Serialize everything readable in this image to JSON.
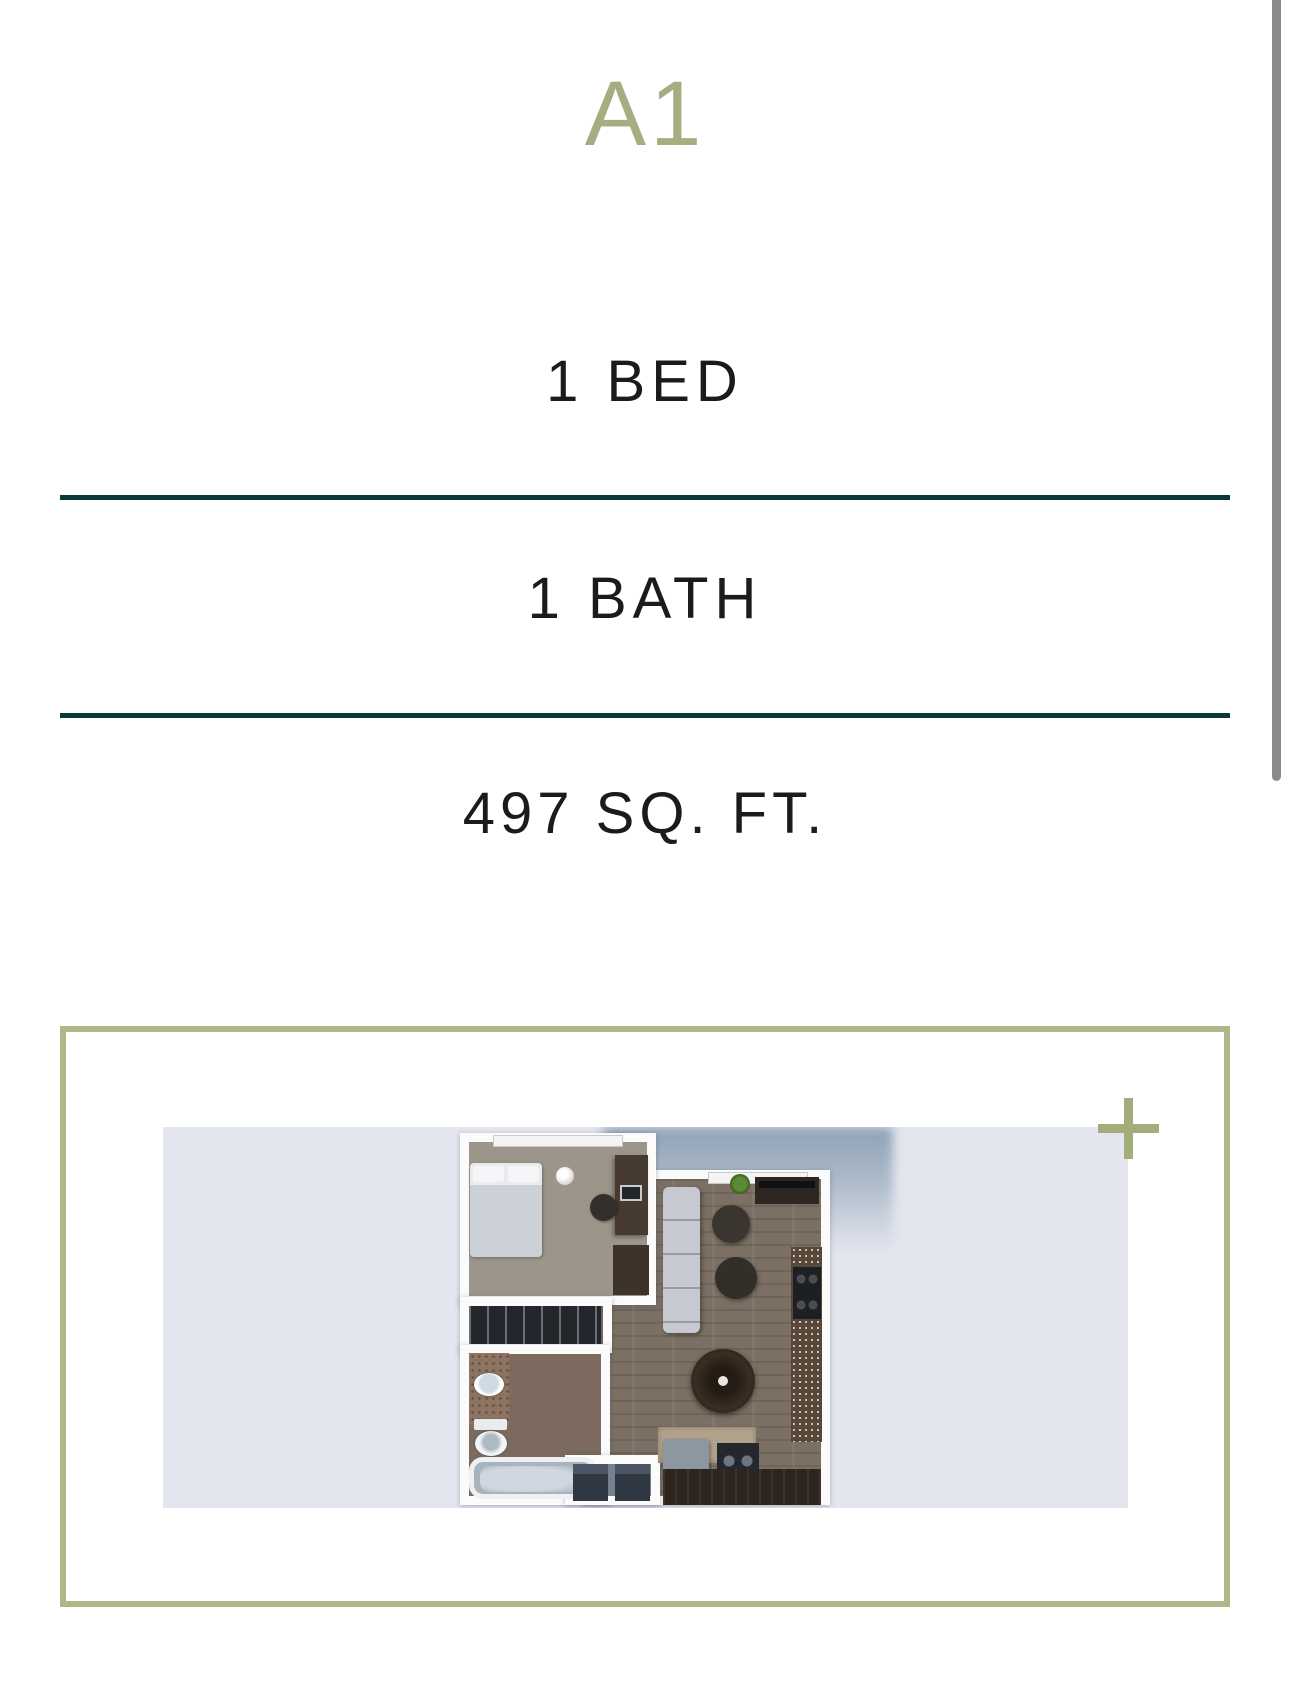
{
  "plan": {
    "name": "A1",
    "beds_label": "1 BED",
    "baths_label": "1 BATH",
    "sqft_label": "497 SQ. FT."
  },
  "colors": {
    "title_sage": "#a7ac81",
    "box_border_sage": "#b0b687",
    "plus_icon_sage": "#a3ad7b",
    "divider_teal": "#0a393c",
    "text_dark": "#1b1b1b",
    "photo_background": "#e4e6ef",
    "scrollbar_gray": "#8a8a8a"
  },
  "icons": {
    "zoom_plus": "plus-icon"
  }
}
